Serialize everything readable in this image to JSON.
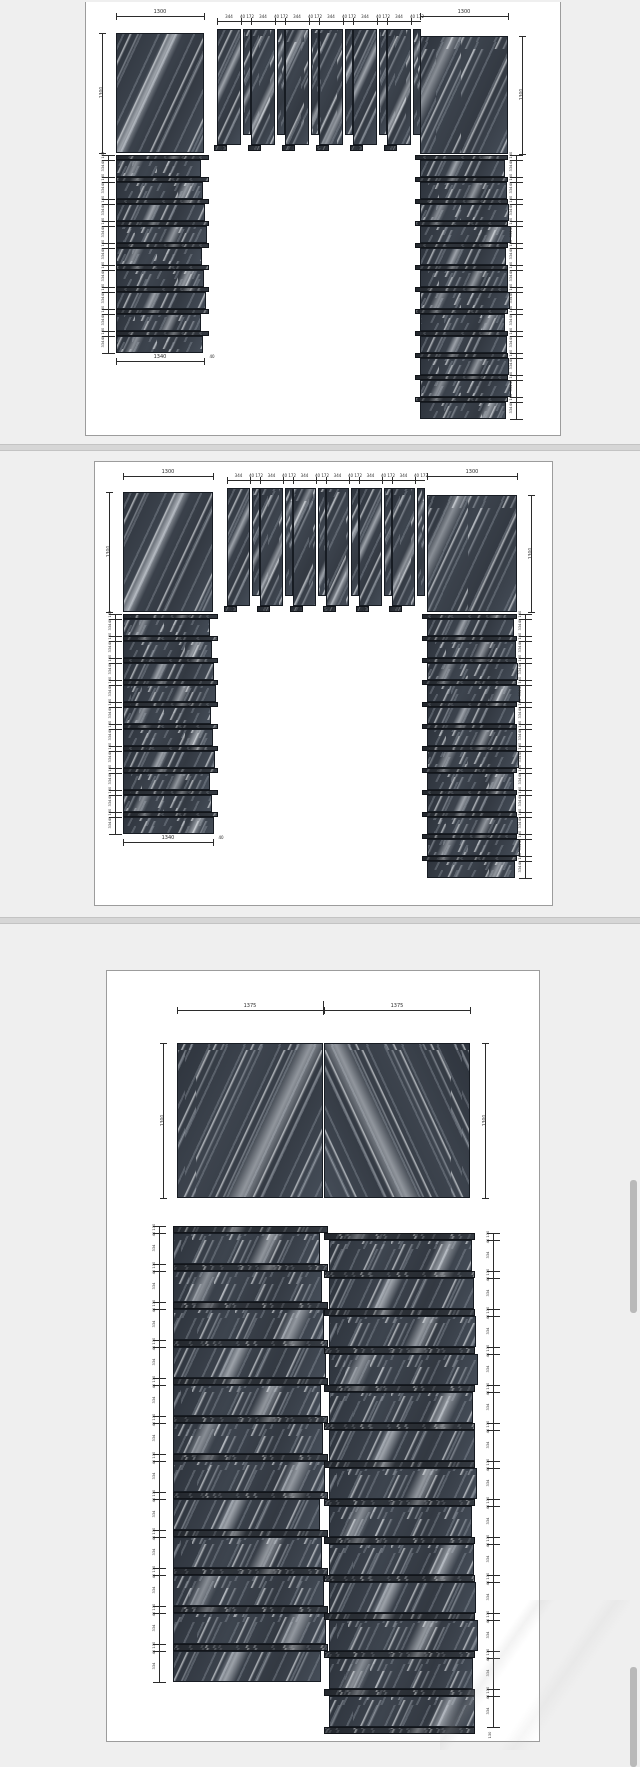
{
  "viewer": {
    "description": "stone slab layout shop drawing, three sheets",
    "scrollbar_thumbs": 2
  },
  "colors": {
    "canvas": "#efefef",
    "page": "#ffffff",
    "page_border": "#9c9c9c",
    "divider": "#d6d6d6",
    "divider_edge": "#c3c3c3",
    "marble_base": "#3b414b",
    "marble_vein": "#c7cdd5",
    "marble_vein_bright": "#edf0f3",
    "dimension": "#2b2b2b",
    "scrollbar": "#b9b9b9"
  },
  "sheets": [
    {
      "id": "sheet-1",
      "kind": "portal-elevation",
      "dims": {
        "top_left_width": "1300",
        "top_right_width": "1300",
        "left_panel_height": "1300",
        "right_panel_height": "1300",
        "slat_width": "344",
        "slat_gap_pair": "40 172",
        "tread_depth": "334",
        "riser_pair": "40 130",
        "bottom_width": "1340",
        "bottom_end": "40"
      },
      "pieces": {
        "left_panel": 1,
        "left_steps": 9,
        "wide_slats": 6,
        "narrow_slats": 6,
        "right_panel": 1,
        "right_steps": 12
      }
    },
    {
      "id": "sheet-2",
      "kind": "portal-elevation",
      "dims": {
        "top_left_width": "1300",
        "top_right_width": "1300",
        "left_panel_height": "1300",
        "right_panel_height": "1300",
        "slat_width": "344",
        "slat_gap_pair": "40 172",
        "tread_depth": "334",
        "riser_pair": "40 130",
        "bottom_width": "1340",
        "bottom_end": "40"
      },
      "pieces": {
        "left_panel": 1,
        "left_steps": 10,
        "wide_slats": 6,
        "narrow_slats": 6,
        "right_panel": 1,
        "right_steps": 12
      }
    },
    {
      "id": "sheet-3",
      "kind": "bookmatch-and-stair-layout",
      "dims": {
        "panel_left_width": "1375",
        "panel_right_width": "1375",
        "panel_height_left": "1300",
        "panel_height_right": "1300",
        "tread_depth": "334",
        "riser_pair": "40 130",
        "riser_height": "130"
      },
      "pieces": {
        "bookmatch_panels": 2,
        "left_steps": 12,
        "right_steps": 13
      }
    }
  ]
}
